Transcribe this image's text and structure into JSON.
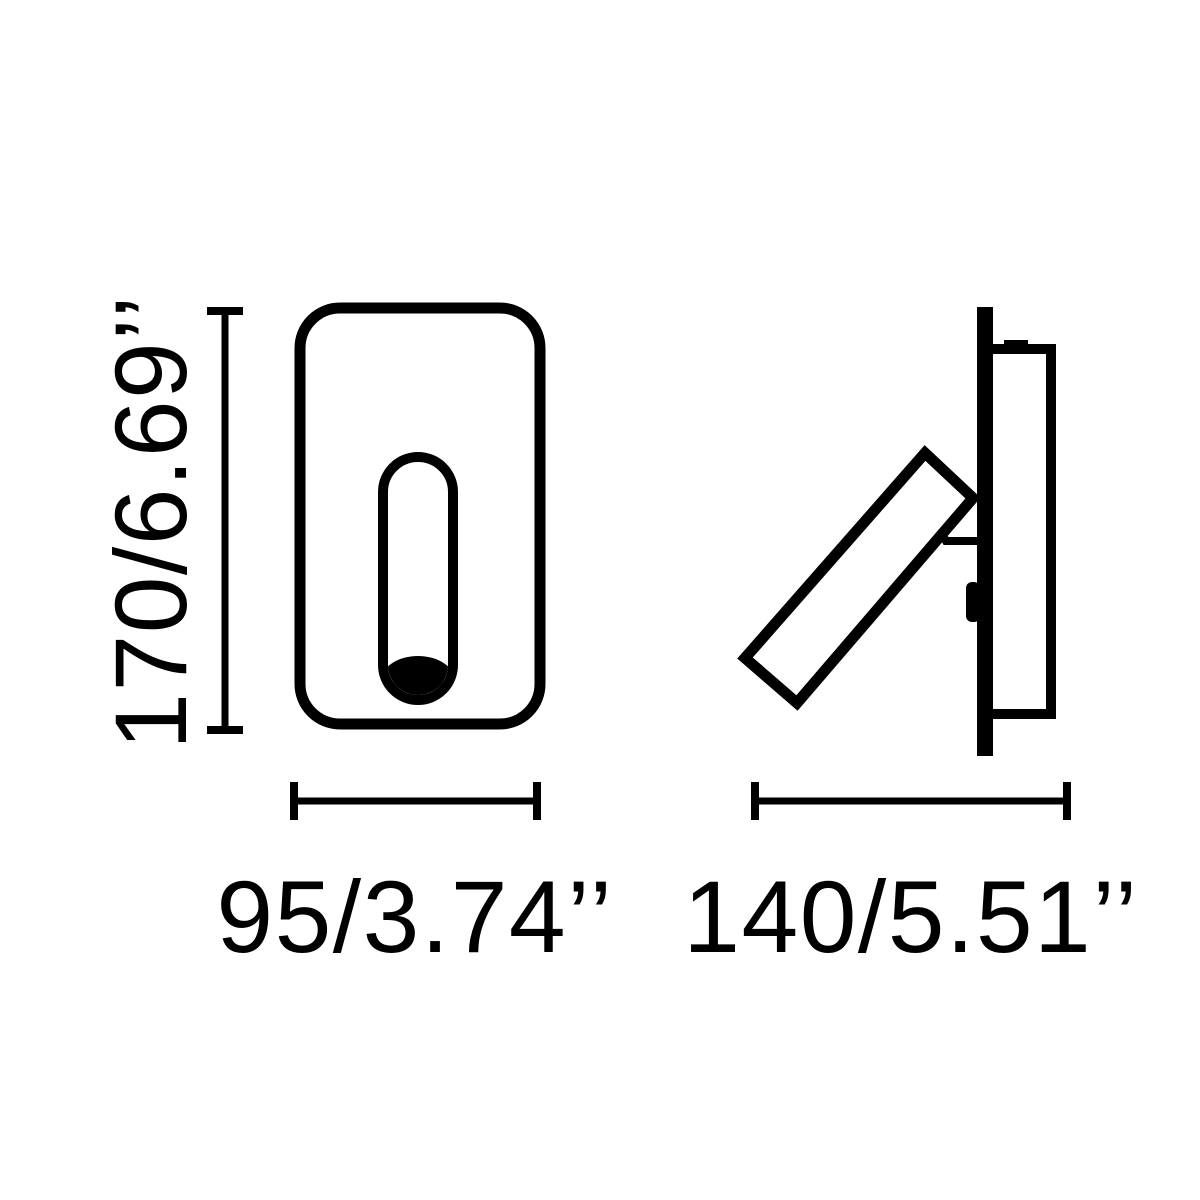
{
  "page": {
    "background_color": "#ffffff",
    "stroke_color": "#000000"
  },
  "drawing": {
    "type": "technical-dimension-drawing",
    "views": {
      "front": "front-view-of-recessed-wall-lamp",
      "side": "side-view-with-adjustable-reading-arm"
    },
    "labels": {
      "height": "170/6.69’’",
      "width": "95/3.74’’",
      "depth": "140/5.51’’"
    }
  }
}
